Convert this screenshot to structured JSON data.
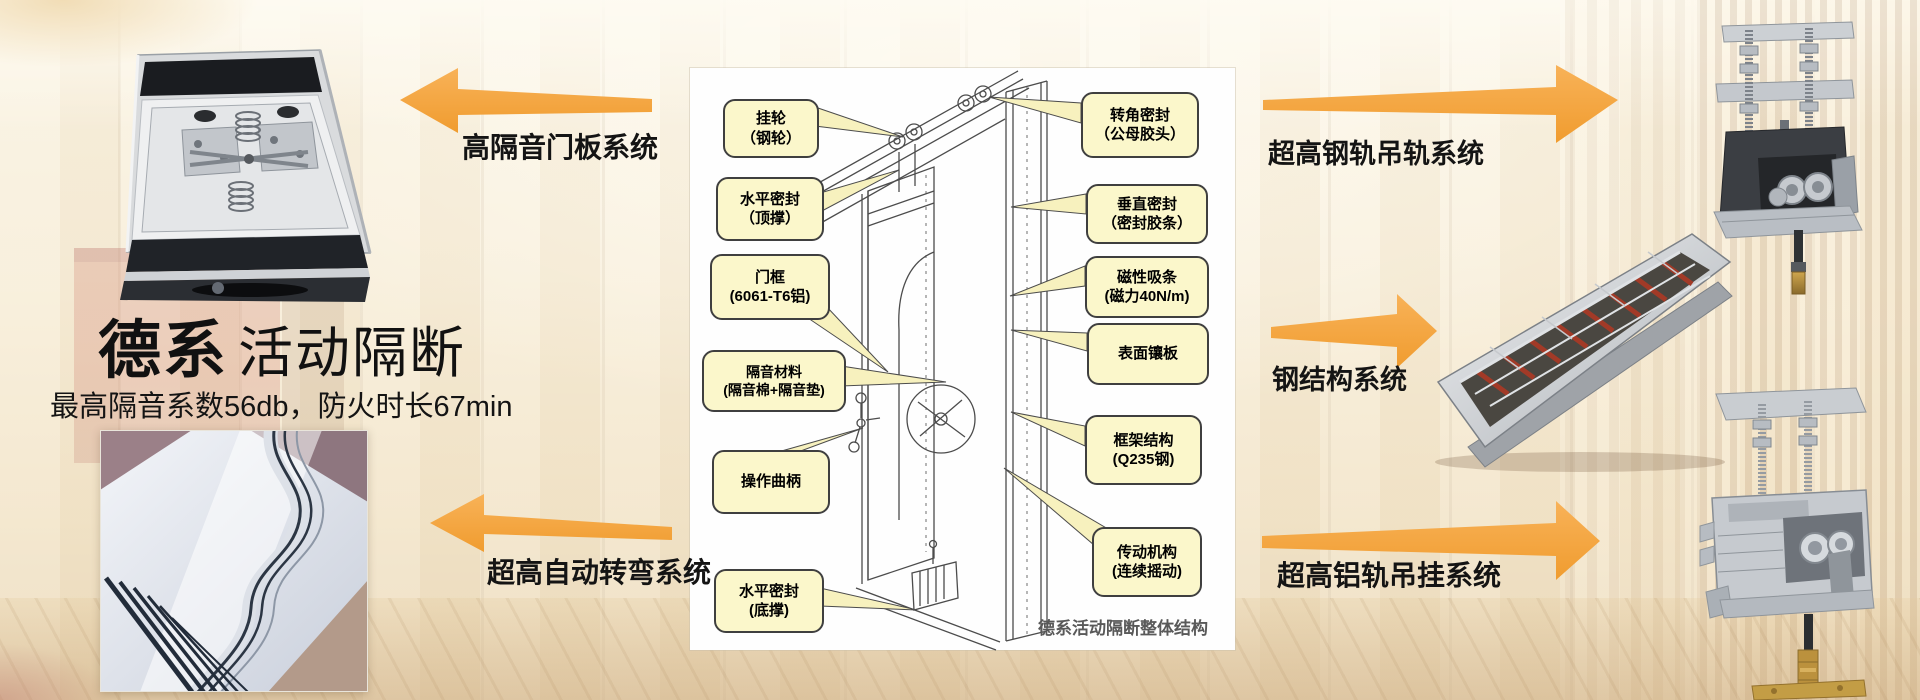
{
  "brand": {
    "title_primary": "德系",
    "title_secondary": "活动隔断",
    "subtitle": "最高隔音系数56db，防火时长67min"
  },
  "system_labels": {
    "door_panel": "高隔音门板系统",
    "auto_turn": "超高自动转弯系统",
    "steel_rail": "超高钢轨吊轨系统",
    "steel_structure": "钢结构系统",
    "alu_rail": "超高铝轨吊挂系统"
  },
  "diagram": {
    "caption": "德系活动隔断整体结构",
    "callouts_left": [
      {
        "line1": "挂轮",
        "line2": "（钢轮）"
      },
      {
        "line1": "水平密封",
        "line2": "（顶撑）"
      },
      {
        "line1": "门框",
        "line2": "(6061-T6铝)"
      },
      {
        "line1": "隔音材料",
        "line2": "(隔音棉+隔音垫)"
      },
      {
        "line1": "操作曲柄",
        "line2": ""
      },
      {
        "line1": "水平密封",
        "line2": "(底撑)"
      }
    ],
    "callouts_right": [
      {
        "line1": "转角密封",
        "line2": "（公母胶头）"
      },
      {
        "line1": "垂直密封",
        "line2": "（密封胶条）"
      },
      {
        "line1": "磁性吸条",
        "line2": "(磁力40N/m)"
      },
      {
        "line1": "表面镶板",
        "line2": ""
      },
      {
        "line1": "框架结构",
        "line2": "(Q235钢)"
      },
      {
        "line1": "传动机构",
        "line2": "(连续摇动)"
      }
    ]
  },
  "colors": {
    "arrow_orange": "#F6A73F",
    "callout_fill": "#FBF7CB",
    "callout_border": "#3F3F3F",
    "wedge_fill": "#F7F1BE"
  }
}
